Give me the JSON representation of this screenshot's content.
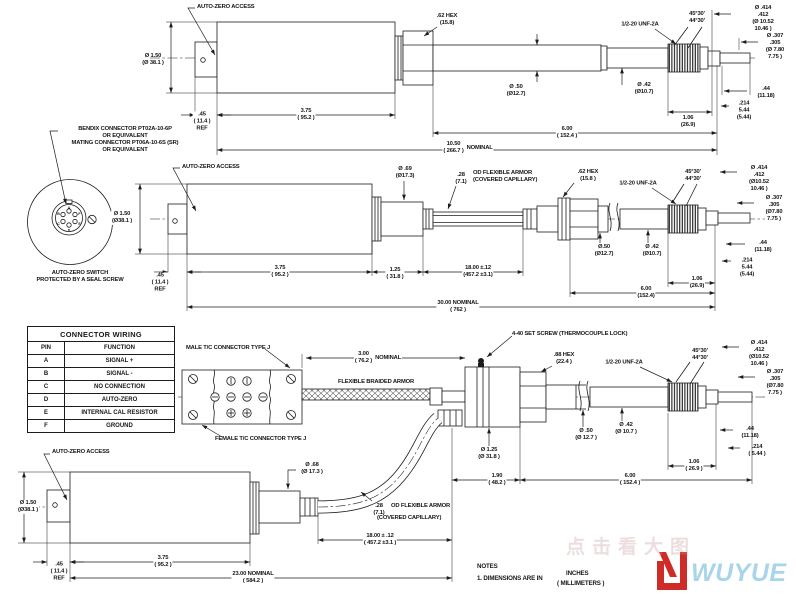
{
  "wiring_table": {
    "title": "CONNECTOR WIRING",
    "headers": {
      "pin": "PIN",
      "function": "FUNCTION"
    },
    "rows": [
      {
        "pin": "A",
        "function": "SIGNAL +"
      },
      {
        "pin": "B",
        "function": "SIGNAL -"
      },
      {
        "pin": "C",
        "function": "NO CONNECTION"
      },
      {
        "pin": "D",
        "function": "AUTO-ZERO"
      },
      {
        "pin": "E",
        "function": "INTERNAL CAL RESISTOR"
      },
      {
        "pin": "F",
        "function": "GROUND"
      }
    ]
  },
  "connector_view": {
    "callout": "BENDIX CONNECTOR PT02A-10-6P\nOR EQUIVALENT\nMATING CONNECTOR PT06A-10-6S (SR)\nOR EQUIVALENT",
    "caption": "AUTO-ZERO SWITCH\nPROTECTED BY A SEAL SCREW",
    "pins": [
      "A",
      "B",
      "C",
      "D",
      "E",
      "F"
    ]
  },
  "v1": {
    "auto_zero": "AUTO-ZERO ACCESS",
    "dia_body": "Ø 1.50\n(Ø 38.1 )",
    "ref": ".45\n( 11.4 )\nREF",
    "len_body": "3.75\n( 95.2 )",
    "hex": ".62 HEX\n(15.8)",
    "dia_shaft": "Ø .50\n(Ø12.7)",
    "dia_stub": "Ø .42\n(Ø10.7)",
    "thread": "1/2-20 UNF-2A",
    "chamfer": "45°30'\n44°30'",
    "dia_tip1": "Ø .414\n.412\n(Ø 10.52\n10.46 )",
    "dia_tip2": "Ø .307\n.305\n(Ø 7.80\n7.75 )",
    "len_tip1": ".44\n(11.18)",
    "len_tip2": ".214\n5.44\n(5.44)",
    "len_thread": "1.06\n(26.9)",
    "len_shaft": "6.00\n( 152.4 )",
    "overall": "10.50\n( 266.7 )",
    "overall_note": "NOMINAL"
  },
  "v2": {
    "auto_zero": "AUTO-ZERO ACCESS",
    "dia_body": "Ø 1.50\n(Ø38.1 )",
    "ref": ".45\n( 11.4 )\nREF",
    "len_body": "3.75\n( 95.2 )",
    "len_adapter": "1.25\n( 31.8 )",
    "dia_adapter": "Ø .69\n(Ø17.3)",
    "dia_armor": ".28\n(7.1)",
    "armor": "OD FLEXIBLE ARMOR\n(COVERED CAPILLARY)",
    "len_armor": "18.00 ±.12\n(457.2 ±3.1)",
    "hex": ".62 HEX\n(15.8 )",
    "dia_shaft": "Ø.50\n(Ø12.7)",
    "dia_stub": "Ø .42\n(Ø10.7)",
    "thread": "1/2-20 UNF-2A",
    "chamfer": "45°30'\n44°30'",
    "dia_tip1": "Ø .414\n.412\n(Ø10.52\n10.46 )",
    "dia_tip2": "Ø .307\n.305\n(Ø7.80\n7.75 )",
    "len_tip1": ".44\n(11.18)",
    "len_tip2": ".214\n5.44\n(5.44)",
    "len_thread": "1.06\n(26.9)",
    "len_shaft": "6.00\n(152.4)",
    "overall": "30.00  NOMINAL\n( 762 )"
  },
  "v3": {
    "male": "MALE T/C CONNECTOR TYPE J",
    "female": "FEMALE T/C CONNECTOR TYPE J",
    "lead": "3.00\n( 76.2 )",
    "lead_note": "NOMINAL",
    "braid": "FLEXIBLE BRAIDED ARMOR",
    "set_screw": "4-40 SET SCREW (THERMOCOUPLE LOCK)",
    "hex": ".88 HEX\n(22.4 )",
    "thread": "1/2-20 UNF-2A",
    "dia_body": "Ø 1.25\n(Ø 31.8 )",
    "dia_shaft": "Ø .50\n(Ø 12.7 )",
    "dia_stub": "Ø .42\n(Ø 10.7 )",
    "len_body": "1.90\n( 48.2 )",
    "len_shaft": "6.00\n( 152.4 )",
    "len_thread": "1.06\n( 26.9 )",
    "chamfer": "45°30'\n44°30'",
    "dia_tip1": "Ø .414\n.412\n(Ø10.52\n10.46 )",
    "dia_tip2": "Ø .307\n.305\n(Ø7.80\n7.75 )",
    "len_tip1": ".44\n(11.18)",
    "len_tip2": ".214\n( 5.44 )"
  },
  "v4": {
    "auto_zero": "AUTO-ZERO ACCESS",
    "dia_body": "Ø 1.50\n(Ø38.1 )",
    "ref": ".45\n( 11.4 )\nREF",
    "len_body": "3.75\n( 95.2 )",
    "dia_adapter": "Ø .68\n(Ø 17.3 )",
    "dia_armor": ".28\n(7.1)",
    "armor": "OD FLEXIBLE ARMOR",
    "armor2": "(COVERED CAPILLARY)",
    "len_armor": "18.00 ± .12\n( 457.2 ±3.1 )",
    "overall": "23.00  NOMINAL\n( 584.2 )"
  },
  "notes": {
    "heading": "NOTES",
    "line1": "1. DIMENSIONS ARE IN",
    "units_top": "INCHES",
    "units_bottom": "( MILLIMETERS )"
  },
  "brand": {
    "watermark": "点击看大图",
    "name": "WUYUE"
  }
}
